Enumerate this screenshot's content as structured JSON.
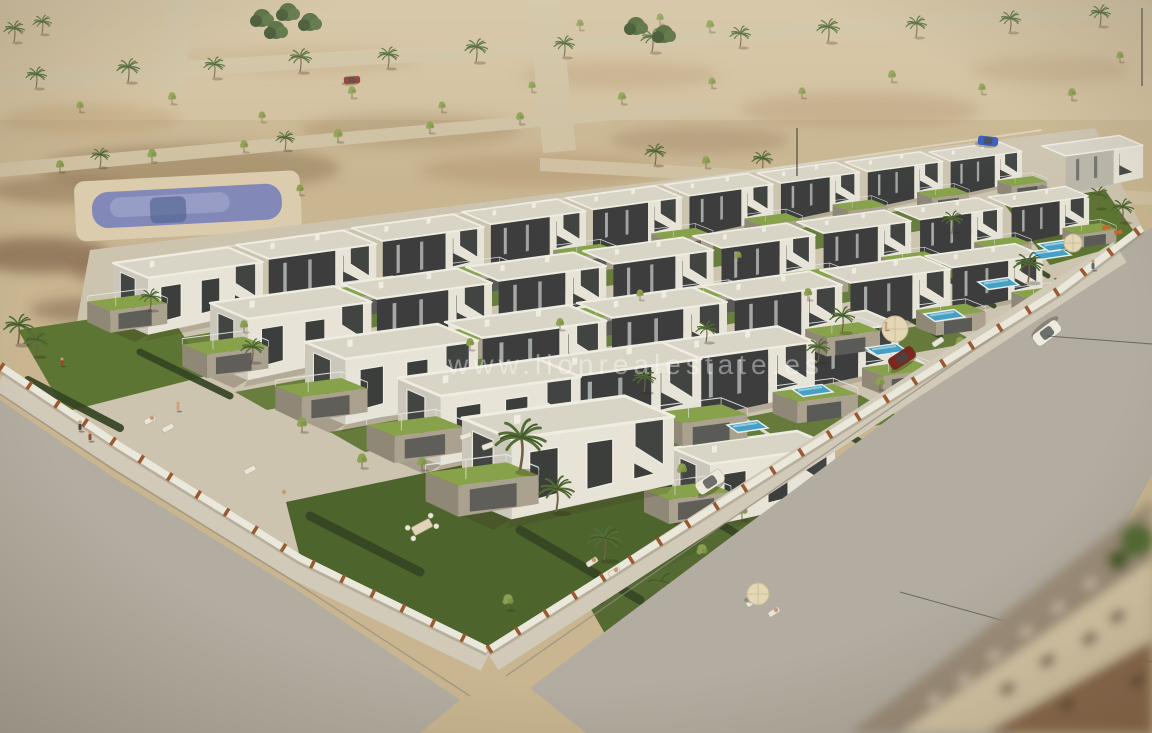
{
  "watermark": {
    "text": "www.lionrealestate.es",
    "color": "#ffffff",
    "opacity": 0.4
  },
  "palette": {
    "sand": "#c9b794",
    "sand_light": "#d8cbaa",
    "road_top": "#cfc2a4",
    "road": "#b2aea5",
    "sidewalk": "#d2ccbf",
    "curb": "#8e8a80",
    "wall_white": "#ecebe3",
    "pillar_rust": "#96552f",
    "roof": "#d9d7cd",
    "fascia": "#f2f1ea",
    "wall_dark": "#33373a",
    "wall_dark2": "#464b4e",
    "villa_white": "#e9e7df",
    "villa_shadow": "#cbc9c0",
    "stone": "#a8a192",
    "stone_dark": "#8d8678",
    "paving": "#cdc6b4",
    "lawn": "#57722f",
    "lawn_dark": "#47602a",
    "lawn_bright": "#83a24a",
    "hedge": "#2c3f20",
    "pool": "#3ea0cd",
    "pool_public": "#7e86bd",
    "palm": "#4d6a33",
    "palm_dark": "#3a5226",
    "tree": "#8aa050",
    "trunk": "#6d5c44",
    "deck": "#dccfb2",
    "umbrella": "#e6dabb"
  },
  "scene": {
    "villas": [
      {
        "x": 113,
        "y": 263,
        "s": 0.92,
        "v": "w"
      },
      {
        "x": 236,
        "y": 245,
        "s": 0.86,
        "v": "d"
      },
      {
        "x": 352,
        "y": 228,
        "s": 0.81,
        "v": "d"
      },
      {
        "x": 462,
        "y": 212,
        "s": 0.76,
        "v": "d"
      },
      {
        "x": 566,
        "y": 198,
        "s": 0.71,
        "v": "d"
      },
      {
        "x": 664,
        "y": 185,
        "s": 0.67,
        "v": "d"
      },
      {
        "x": 757,
        "y": 173,
        "s": 0.63,
        "v": "d"
      },
      {
        "x": 845,
        "y": 162,
        "s": 0.6,
        "v": "d"
      },
      {
        "x": 929,
        "y": 152,
        "s": 0.57,
        "v": "d"
      },
      {
        "x": 1042,
        "y": 146,
        "s": 0.62,
        "v": "l"
      },
      {
        "x": 210,
        "y": 303,
        "s": 0.99,
        "v": "w"
      },
      {
        "x": 342,
        "y": 284,
        "s": 0.92,
        "v": "d"
      },
      {
        "x": 466,
        "y": 267,
        "s": 0.86,
        "v": "d"
      },
      {
        "x": 583,
        "y": 251,
        "s": 0.8,
        "v": "d"
      },
      {
        "x": 693,
        "y": 236,
        "s": 0.75,
        "v": "d"
      },
      {
        "x": 797,
        "y": 222,
        "s": 0.7,
        "v": "d"
      },
      {
        "x": 895,
        "y": 209,
        "s": 0.66,
        "v": "d"
      },
      {
        "x": 988,
        "y": 197,
        "s": 0.62,
        "v": "d"
      },
      {
        "x": 305,
        "y": 342,
        "s": 1.06,
        "v": "w"
      },
      {
        "x": 445,
        "y": 322,
        "s": 0.99,
        "v": "d"
      },
      {
        "x": 577,
        "y": 303,
        "s": 0.92,
        "v": "d"
      },
      {
        "x": 702,
        "y": 286,
        "s": 0.86,
        "v": "d"
      },
      {
        "x": 820,
        "y": 270,
        "s": 0.8,
        "v": "d"
      },
      {
        "x": 925,
        "y": 256,
        "s": 0.72,
        "v": "d"
      },
      {
        "x": 398,
        "y": 378,
        "s": 1.12,
        "v": "w"
      },
      {
        "x": 530,
        "y": 360,
        "s": 1.05,
        "v": "d"
      },
      {
        "x": 655,
        "y": 343,
        "s": 0.98,
        "v": "d"
      },
      {
        "x": 760,
        "y": 325,
        "s": 0.85,
        "v": "d"
      },
      {
        "x": 462,
        "y": 418,
        "s": 1.3,
        "v": "w"
      },
      {
        "x": 672,
        "y": 448,
        "s": 1.0,
        "v": "w"
      }
    ],
    "pools": [
      {
        "x": 727,
        "y": 425
      },
      {
        "x": 792,
        "y": 389
      },
      {
        "x": 866,
        "y": 348
      },
      {
        "x": 924,
        "y": 314
      },
      {
        "x": 978,
        "y": 282
      },
      {
        "x": 1030,
        "y": 252
      },
      {
        "x": 1038,
        "y": 244
      }
    ],
    "hedges": [
      {
        "x1": 660,
        "y1": 402,
        "x2": 742,
        "y2": 450,
        "w": 7
      },
      {
        "x1": 726,
        "y1": 362,
        "x2": 808,
        "y2": 410,
        "w": 7
      },
      {
        "x1": 800,
        "y1": 322,
        "x2": 882,
        "y2": 370,
        "w": 6
      },
      {
        "x1": 858,
        "y1": 288,
        "x2": 940,
        "y2": 336,
        "w": 6
      },
      {
        "x1": 912,
        "y1": 258,
        "x2": 994,
        "y2": 306,
        "w": 5
      },
      {
        "x1": 966,
        "y1": 228,
        "x2": 1048,
        "y2": 276,
        "w": 5
      },
      {
        "x1": 596,
        "y1": 440,
        "x2": 678,
        "y2": 488,
        "w": 8
      },
      {
        "x1": 520,
        "y1": 530,
        "x2": 640,
        "y2": 600,
        "w": 9
      },
      {
        "x1": 28,
        "y1": 380,
        "x2": 120,
        "y2": 428,
        "w": 8
      },
      {
        "x1": 140,
        "y1": 352,
        "x2": 230,
        "y2": 396,
        "w": 7
      },
      {
        "x1": 310,
        "y1": 516,
        "x2": 420,
        "y2": 572,
        "w": 9
      },
      {
        "x1": 508,
        "y1": 640,
        "x2": 600,
        "y2": 600,
        "w": 9
      },
      {
        "x1": 680,
        "y1": 500,
        "x2": 760,
        "y2": 548,
        "w": 8
      },
      {
        "x1": 840,
        "y1": 430,
        "x2": 920,
        "y2": 478,
        "w": 7
      }
    ],
    "garden_walls": [
      {
        "x1": 700,
        "y1": 390,
        "x2": 790,
        "y2": 448
      },
      {
        "x1": 764,
        "y1": 350,
        "x2": 854,
        "y2": 408
      },
      {
        "x1": 838,
        "y1": 309,
        "x2": 928,
        "y2": 367
      },
      {
        "x1": 896,
        "y1": 276,
        "x2": 986,
        "y2": 334
      },
      {
        "x1": 950,
        "y1": 246,
        "x2": 1040,
        "y2": 304
      },
      {
        "x1": 628,
        "y1": 432,
        "x2": 718,
        "y2": 490
      }
    ],
    "desert_palms": [
      {
        "x": 36,
        "y": 88,
        "s": 0.5
      },
      {
        "x": 128,
        "y": 82,
        "s": 0.55
      },
      {
        "x": 214,
        "y": 78,
        "s": 0.5
      },
      {
        "x": 300,
        "y": 72,
        "s": 0.55
      },
      {
        "x": 388,
        "y": 68,
        "s": 0.5
      },
      {
        "x": 476,
        "y": 62,
        "s": 0.55
      },
      {
        "x": 564,
        "y": 57,
        "s": 0.5
      },
      {
        "x": 652,
        "y": 52,
        "s": 0.55
      },
      {
        "x": 740,
        "y": 47,
        "s": 0.5
      },
      {
        "x": 828,
        "y": 42,
        "s": 0.55
      },
      {
        "x": 916,
        "y": 37,
        "s": 0.5
      },
      {
        "x": 1010,
        "y": 32,
        "s": 0.5
      },
      {
        "x": 1100,
        "y": 26,
        "s": 0.5
      },
      {
        "x": 14,
        "y": 42,
        "s": 0.5
      },
      {
        "x": 42,
        "y": 34,
        "s": 0.45
      },
      {
        "x": 655,
        "y": 165,
        "s": 0.5
      },
      {
        "x": 762,
        "y": 172,
        "s": 0.5
      },
      {
        "x": 898,
        "y": 182,
        "s": 0.55
      },
      {
        "x": 1038,
        "y": 193,
        "s": 0.55
      },
      {
        "x": 100,
        "y": 167,
        "s": 0.45
      },
      {
        "x": 285,
        "y": 150,
        "s": 0.45
      }
    ],
    "desert_trees": [
      {
        "x": 60,
        "y": 172,
        "s": 0.45
      },
      {
        "x": 152,
        "y": 162,
        "s": 0.5
      },
      {
        "x": 244,
        "y": 152,
        "s": 0.45
      },
      {
        "x": 338,
        "y": 142,
        "s": 0.5
      },
      {
        "x": 430,
        "y": 133,
        "s": 0.45
      },
      {
        "x": 300,
        "y": 195,
        "s": 0.4
      },
      {
        "x": 520,
        "y": 124,
        "s": 0.45
      },
      {
        "x": 80,
        "y": 112,
        "s": 0.4
      },
      {
        "x": 172,
        "y": 104,
        "s": 0.45
      },
      {
        "x": 262,
        "y": 122,
        "s": 0.4
      },
      {
        "x": 352,
        "y": 98,
        "s": 0.45
      },
      {
        "x": 442,
        "y": 112,
        "s": 0.4
      },
      {
        "x": 532,
        "y": 92,
        "s": 0.4
      },
      {
        "x": 622,
        "y": 104,
        "s": 0.45
      },
      {
        "x": 712,
        "y": 88,
        "s": 0.4
      },
      {
        "x": 802,
        "y": 98,
        "s": 0.4
      },
      {
        "x": 892,
        "y": 82,
        "s": 0.45
      },
      {
        "x": 982,
        "y": 94,
        "s": 0.4
      },
      {
        "x": 1072,
        "y": 100,
        "s": 0.45
      },
      {
        "x": 1120,
        "y": 62,
        "s": 0.4
      },
      {
        "x": 950,
        "y": 205,
        "s": 0.45
      },
      {
        "x": 1040,
        "y": 197,
        "s": 0.4
      },
      {
        "x": 706,
        "y": 168,
        "s": 0.45
      },
      {
        "x": 830,
        "y": 177,
        "s": 0.5
      },
      {
        "x": 962,
        "y": 187,
        "s": 0.5
      },
      {
        "x": 1098,
        "y": 198,
        "s": 0.45
      },
      {
        "x": 580,
        "y": 30,
        "s": 0.4
      },
      {
        "x": 660,
        "y": 24,
        "s": 0.4
      },
      {
        "x": 710,
        "y": 32,
        "s": 0.45
      }
    ],
    "bushes": [
      {
        "x": 262,
        "y": 18
      },
      {
        "x": 288,
        "y": 12
      },
      {
        "x": 310,
        "y": 22
      },
      {
        "x": 276,
        "y": 30
      },
      {
        "x": 636,
        "y": 26
      },
      {
        "x": 664,
        "y": 34
      }
    ],
    "block_palms": [
      {
        "x": 520,
        "y": 470,
        "s": 1.2
      },
      {
        "x": 556,
        "y": 512,
        "s": 0.85
      },
      {
        "x": 18,
        "y": 344,
        "s": 0.7
      },
      {
        "x": 36,
        "y": 356,
        "s": 0.6
      },
      {
        "x": 252,
        "y": 362,
        "s": 0.55
      },
      {
        "x": 150,
        "y": 310,
        "s": 0.5
      },
      {
        "x": 842,
        "y": 332,
        "s": 0.6
      },
      {
        "x": 818,
        "y": 362,
        "s": 0.55
      },
      {
        "x": 1028,
        "y": 282,
        "s": 0.7
      },
      {
        "x": 1062,
        "y": 302,
        "s": 0.6
      },
      {
        "x": 952,
        "y": 232,
        "s": 0.5
      },
      {
        "x": 706,
        "y": 342,
        "s": 0.5
      },
      {
        "x": 644,
        "y": 392,
        "s": 0.55
      },
      {
        "x": 604,
        "y": 560,
        "s": 0.8
      },
      {
        "x": 660,
        "y": 600,
        "s": 0.7
      },
      {
        "x": 1098,
        "y": 208,
        "s": 0.5
      },
      {
        "x": 1122,
        "y": 222,
        "s": 0.55
      }
    ],
    "block_trees": [
      {
        "x": 302,
        "y": 432,
        "s": 0.55
      },
      {
        "x": 362,
        "y": 468,
        "s": 0.55
      },
      {
        "x": 682,
        "y": 478,
        "s": 0.55
      },
      {
        "x": 742,
        "y": 520,
        "s": 0.6
      },
      {
        "x": 244,
        "y": 332,
        "s": 0.45
      },
      {
        "x": 586,
        "y": 602,
        "s": 0.65
      },
      {
        "x": 628,
        "y": 642,
        "s": 0.65
      },
      {
        "x": 422,
        "y": 470,
        "s": 0.5
      },
      {
        "x": 702,
        "y": 560,
        "s": 0.6
      },
      {
        "x": 508,
        "y": 610,
        "s": 0.6
      },
      {
        "x": 960,
        "y": 350,
        "s": 0.5
      },
      {
        "x": 1010,
        "y": 330,
        "s": 0.5
      },
      {
        "x": 880,
        "y": 390,
        "s": 0.5
      },
      {
        "x": 808,
        "y": 300,
        "s": 0.45
      },
      {
        "x": 738,
        "y": 262,
        "s": 0.4
      },
      {
        "x": 640,
        "y": 300,
        "s": 0.4
      },
      {
        "x": 560,
        "y": 330,
        "s": 0.45
      },
      {
        "x": 470,
        "y": 350,
        "s": 0.45
      }
    ],
    "cars": [
      {
        "x": 988,
        "y": 141,
        "a": 6,
        "c": "#2b55c8",
        "l": 20,
        "w": 9,
        "name": "blue-car-top-road"
      },
      {
        "x": 352,
        "y": 80,
        "a": -4,
        "c": "#8d2f26",
        "l": 16,
        "w": 7,
        "name": "red-car-top-road"
      },
      {
        "x": 1047,
        "y": 333,
        "a": 143,
        "c": "#f0eee6",
        "l": 30,
        "w": 14,
        "name": "white-car-main-road"
      },
      {
        "x": 710,
        "y": 482,
        "a": -33,
        "c": "#efece2",
        "l": 30,
        "w": 14,
        "name": "white-car-driveway"
      },
      {
        "x": 902,
        "y": 358,
        "a": -33,
        "c": "#7a1f1a",
        "l": 28,
        "w": 13,
        "name": "dark-red-car-garden"
      }
    ],
    "people": [
      {
        "x": 1093,
        "y": 270,
        "s": 1,
        "c": "#4c6382"
      },
      {
        "x": 80,
        "y": 431,
        "s": 1,
        "c": "#3f3f3f"
      },
      {
        "x": 90,
        "y": 441,
        "s": 1,
        "c": "#8a4a3a"
      },
      {
        "x": 178,
        "y": 411,
        "s": 0.9,
        "c": "#c8a07c"
      },
      {
        "x": 62,
        "y": 366,
        "s": 0.8,
        "c": "#a03a2e"
      },
      {
        "x": 886,
        "y": 330,
        "s": 0.8,
        "c": "#c8a07c"
      }
    ],
    "loungers": [
      {
        "x": 466,
        "y": 436,
        "a": -20
      },
      {
        "x": 488,
        "y": 446,
        "a": -20
      },
      {
        "x": 592,
        "y": 562,
        "a": -33
      },
      {
        "x": 614,
        "y": 572,
        "a": -33
      },
      {
        "x": 150,
        "y": 420,
        "a": -28
      },
      {
        "x": 168,
        "y": 428,
        "a": -28
      },
      {
        "x": 752,
        "y": 602,
        "a": -33
      },
      {
        "x": 774,
        "y": 612,
        "a": -33
      },
      {
        "x": 938,
        "y": 342,
        "a": -33
      },
      {
        "x": 250,
        "y": 470,
        "a": -28
      }
    ],
    "sunbathers": [
      {
        "x": 594,
        "y": 560
      },
      {
        "x": 616,
        "y": 570
      },
      {
        "x": 754,
        "y": 600
      },
      {
        "x": 776,
        "y": 610
      },
      {
        "x": 152,
        "y": 418
      },
      {
        "x": 284,
        "y": 492
      }
    ],
    "umbrellas": [
      {
        "x": 895,
        "y": 329,
        "r": 13
      },
      {
        "x": 758,
        "y": 594,
        "r": 11
      },
      {
        "x": 1073,
        "y": 243,
        "r": 9
      }
    ],
    "tables": [
      {
        "x": 422,
        "y": 527,
        "a": -28
      }
    ],
    "playsets": [
      {
        "x": 1102,
        "y": 226
      },
      {
        "x": 1114,
        "y": 231
      }
    ],
    "wires": [
      {
        "x1": 1047,
        "y1": 336,
        "x2": 1152,
        "y2": 344
      },
      {
        "x1": 900,
        "y1": 592,
        "x2": 1152,
        "y2": 662
      }
    ],
    "poles": [
      {
        "x1": 1142,
        "y1": 8,
        "x2": 1142,
        "y2": 86
      },
      {
        "x1": 797,
        "y1": 128,
        "x2": 797,
        "y2": 176
      }
    ]
  }
}
